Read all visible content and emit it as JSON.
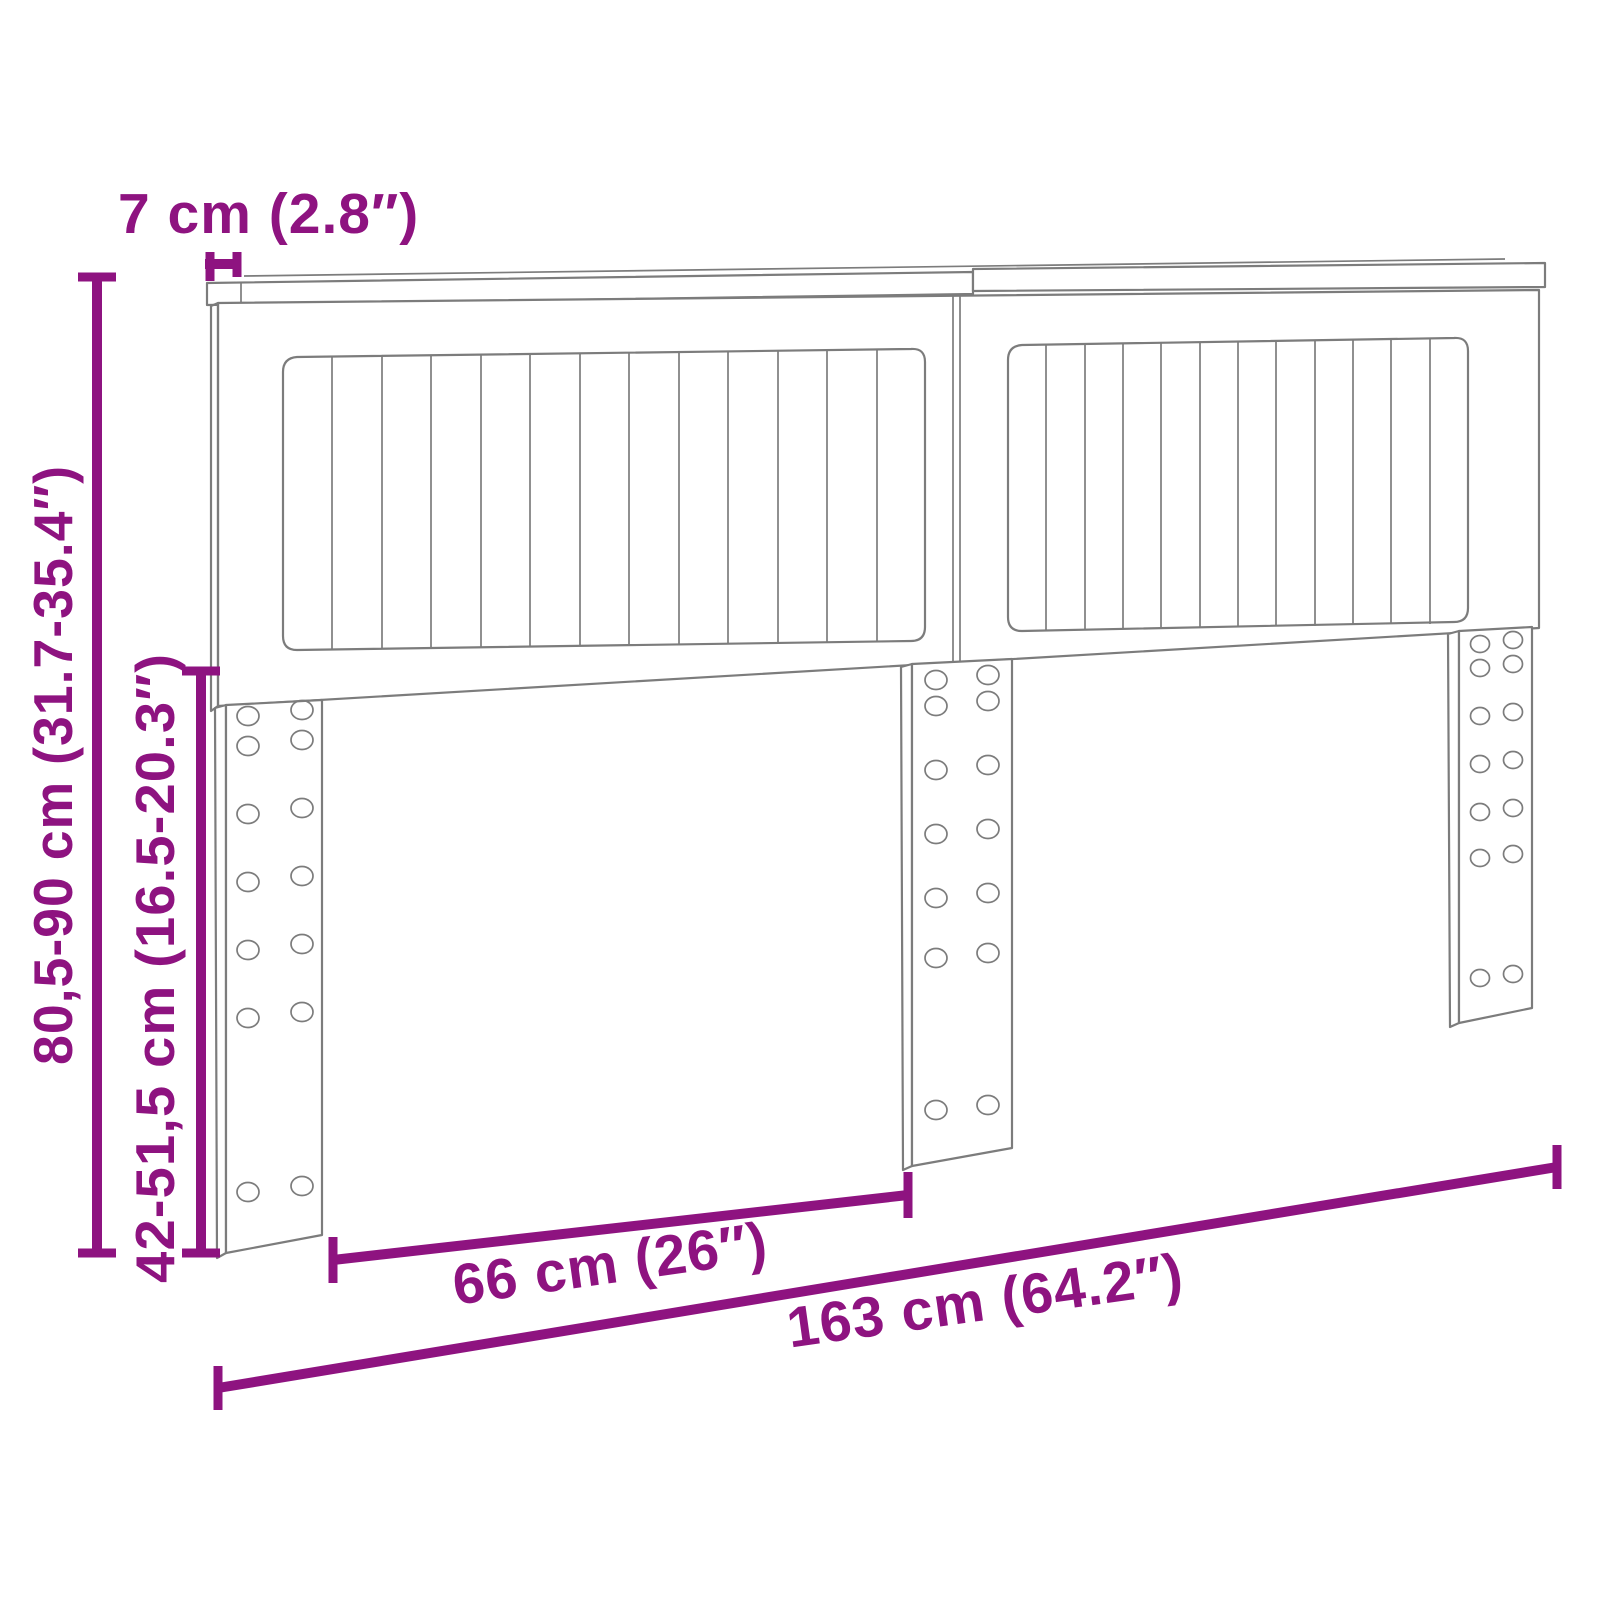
{
  "diagram": {
    "title": "Headboard dimension diagram",
    "product": "headboard-with-slatted-panels-and-three-legs",
    "colors": {
      "dimension": "#8e1380",
      "line_art": "#7c7c7c",
      "background": "#ffffff"
    },
    "labels": {
      "board_thickness": "7 cm (2.8″)",
      "overall_height": "80,5-90 cm (31.7-35.4″)",
      "leg_height": "42-51,5 cm (16.5-20.3″)",
      "leg_spacing": "66 cm (26″)",
      "overall_width": "163 cm (64.2″)"
    }
  }
}
